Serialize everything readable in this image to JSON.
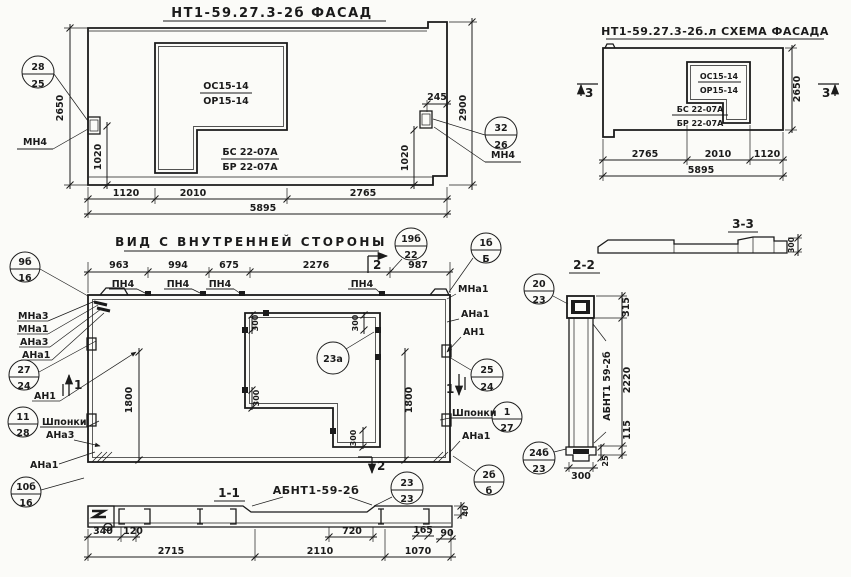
{
  "facade": {
    "title": "НТ1-59.27.3-2б ФАСАД",
    "win_top1": "ОС15-14",
    "win_top2": "ОР15-14",
    "win_bot1": "БС 22-07А",
    "win_bot2": "БР 22-07А",
    "dim_h_left": "2650",
    "dim_h_right": "2900",
    "dim_1020_left": "1020",
    "dim_1020_right": "1020",
    "dim_245": "245",
    "dims_bottom": [
      "1120",
      "2010",
      "2765"
    ],
    "dim_total": "5895",
    "callout_left": {
      "top": "28",
      "bottom": "25"
    },
    "callout_right": {
      "top": "32",
      "bottom": "26"
    },
    "anchor_label_left": "МН4",
    "anchor_label_right": "МН4"
  },
  "schema": {
    "title": "НТ1-59.27.3-2б.л СХЕМА ФАСАДА",
    "win_top1": "ОС15-14",
    "win_top2": "ОР15-14",
    "win_bot1": "БС 22-07А",
    "win_bot2": "БР 22-07А",
    "dims_bottom": [
      "2765",
      "2010",
      "1120"
    ],
    "dim_total": "5895",
    "dim_h_right": "2650",
    "section_left": "3",
    "section_right": "3"
  },
  "section33": {
    "title": "3-3",
    "dim_height": "300"
  },
  "inner": {
    "title": "ВИД С ВНУТРЕННЕЙ СТОРОНЫ",
    "dims_top": [
      "963",
      "994",
      "675",
      "2276",
      "987"
    ],
    "pn_labels": [
      "ПН4",
      "ПН4",
      "ПН4",
      "ПН4"
    ],
    "callout_top_left": {
      "top": "9б",
      "bottom": "16"
    },
    "callout_top_right": {
      "top": "19б",
      "bottom": "22"
    },
    "callout_corner_right": {
      "top": "1б",
      "bottom": "Б"
    },
    "left_labels": [
      "МНа3",
      "МНа1",
      "АНа3",
      "АНа1"
    ],
    "callout_left_mid": {
      "top": "27",
      "bottom": "24"
    },
    "label_an1_left": "АН1",
    "callout_left_low": {
      "top": "11",
      "bottom": "28"
    },
    "label_shponki_left": "Шпонки",
    "label_ana3_left": "АНа3",
    "label_ana1_left": "АНа1",
    "callout_bottom_left": {
      "top": "10б",
      "bottom": "16"
    },
    "label_mna1_right": "МНа1",
    "label_ana1_right_top": "АНа1",
    "label_an1_right": "АН1",
    "callout_right_mid": {
      "top": "25",
      "bottom": "24"
    },
    "label_shponki_right": "Шпонки",
    "callout_right_low": {
      "top": "1",
      "bottom": "27"
    },
    "label_ana1_right_bot": "АНа1",
    "callout_bottom_right": {
      "top": "2б",
      "bottom": "б"
    },
    "callout_opening": "23а",
    "dim_300": "300",
    "dim_left_height": "1800",
    "dim_right_height": "1800",
    "section1": "1",
    "section2": "2"
  },
  "section11": {
    "title": "1-1",
    "label": "АБНТ1-59-2б",
    "callout": {
      "top": "23",
      "bottom": "23"
    },
    "dims": {
      "d340": "340",
      "d120": "120",
      "d720": "720",
      "d165": "165",
      "d90": "90",
      "d2715": "2715",
      "d2110": "2110",
      "d1070": "1070",
      "d40": "40"
    }
  },
  "section22": {
    "title": "2-2",
    "label_vertical": "АБНТ1 59-2б",
    "callout_top": {
      "top": "20",
      "bottom": "23"
    },
    "callout_bottom": {
      "top": "24б",
      "bottom": "23"
    },
    "dims": {
      "d315": "315",
      "d2220": "2220",
      "d115": "115",
      "d25": "25",
      "d300": "300"
    }
  }
}
